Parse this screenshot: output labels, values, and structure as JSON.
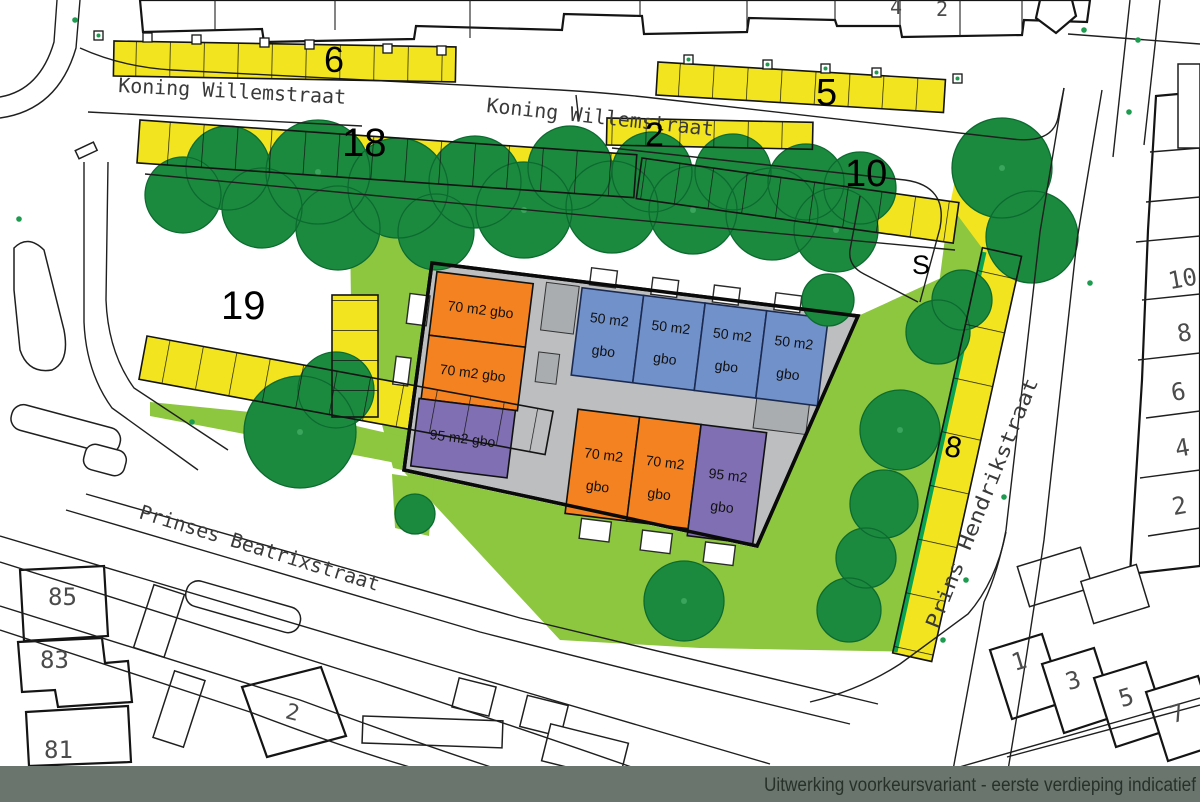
{
  "map": {
    "caption": "Uitwerking voorkeursvariant - eerste verdieping indicatief",
    "streets": {
      "koning_left": "Koning Willemstraat",
      "koning_right": "Koning Willemstraat",
      "beatrix": "Prinses Beatrixstraat",
      "hendrik": "Prins Hendrikstraat"
    },
    "area_numbers": {
      "n6": "6",
      "n5": "5",
      "n2": "2",
      "n18": "18",
      "n10": "10",
      "n19": "19",
      "n8": "8",
      "s": "S"
    },
    "house_numbers": {
      "left": [
        "85",
        "83",
        "81"
      ],
      "bottom_center": "2",
      "bottom_right": [
        "1",
        "3",
        "5",
        "7"
      ],
      "right_column": [
        "10",
        "8",
        "6",
        "4",
        "2"
      ],
      "top_edge": [
        "4",
        "2"
      ]
    },
    "units": {
      "left_column": [
        "70 m2 gbo",
        "70 m2 gbo",
        "95 m2 gbo"
      ],
      "top_row": [
        {
          "l1": "50 m2",
          "l2": "gbo"
        },
        {
          "l1": "50 m2",
          "l2": "gbo"
        },
        {
          "l1": "50 m2",
          "l2": "gbo"
        },
        {
          "l1": "50 m2",
          "l2": "gbo"
        }
      ],
      "bottom_row": [
        {
          "l1": "70 m2",
          "l2": "gbo"
        },
        {
          "l1": "70 m2",
          "l2": "gbo"
        },
        {
          "l1": "95 m2",
          "l2": "gbo"
        }
      ]
    },
    "colors": {
      "tree_green": "#1B8A3F",
      "grass_green": "#8DC63F",
      "parking_yellow": "#F2E51F",
      "unit_orange": "#F58220",
      "unit_blue": "#7191CB",
      "unit_purple": "#8070B3",
      "block_gray": "#BCBEC0",
      "hedge_green": "#0AA350",
      "caption_bar": "#6A756E"
    }
  }
}
